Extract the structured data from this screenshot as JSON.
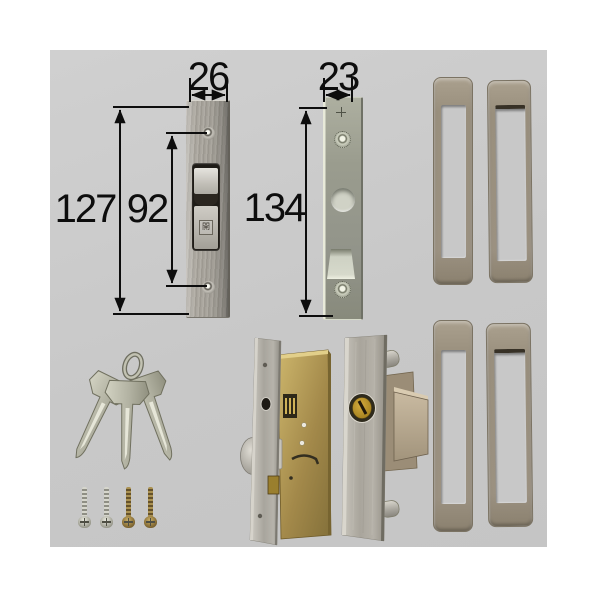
{
  "annotations": {
    "plate1_width": "26",
    "plate1_height": "127",
    "plate1_screw_pitch": "92",
    "plate2_width": "23",
    "plate2_height": "134"
  },
  "stamps": {
    "thumbturn_label": "開"
  },
  "colors": {
    "page_bg": "#ffffff",
    "photo_bg": "#cacaca",
    "dimension_lines": "#0d0d0d",
    "metal_silver": "#aaa69e",
    "zinc_plate": "#999b8d",
    "brass_case": "#a3894a",
    "brass_cylinder": "#b08c28",
    "frame_tan": "#9b9181",
    "key_silver": "#b9b9a9"
  }
}
